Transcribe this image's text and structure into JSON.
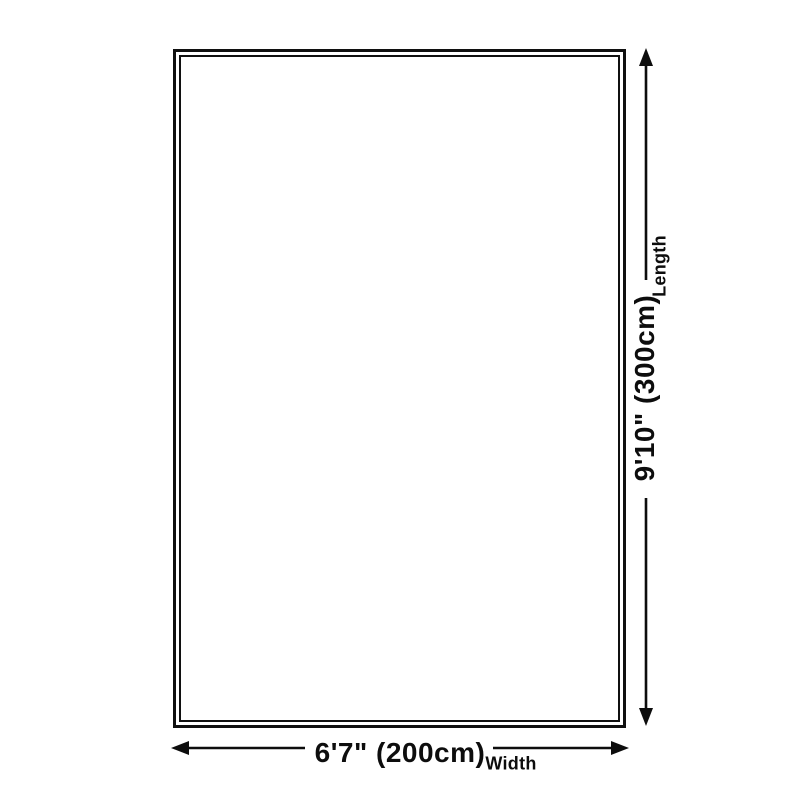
{
  "diagram": {
    "type": "product-dimension-diagram",
    "shape": "rectangle",
    "width_dimension": {
      "value": "6'7\" (200cm)",
      "label": "Width"
    },
    "length_dimension": {
      "value": "9'10\" (300cm)",
      "label": "Length"
    }
  },
  "colors": {
    "background": "#ffffff",
    "outline": "#101010",
    "dimension_line": "#0d0d0d",
    "text": "#0d0d0d"
  }
}
